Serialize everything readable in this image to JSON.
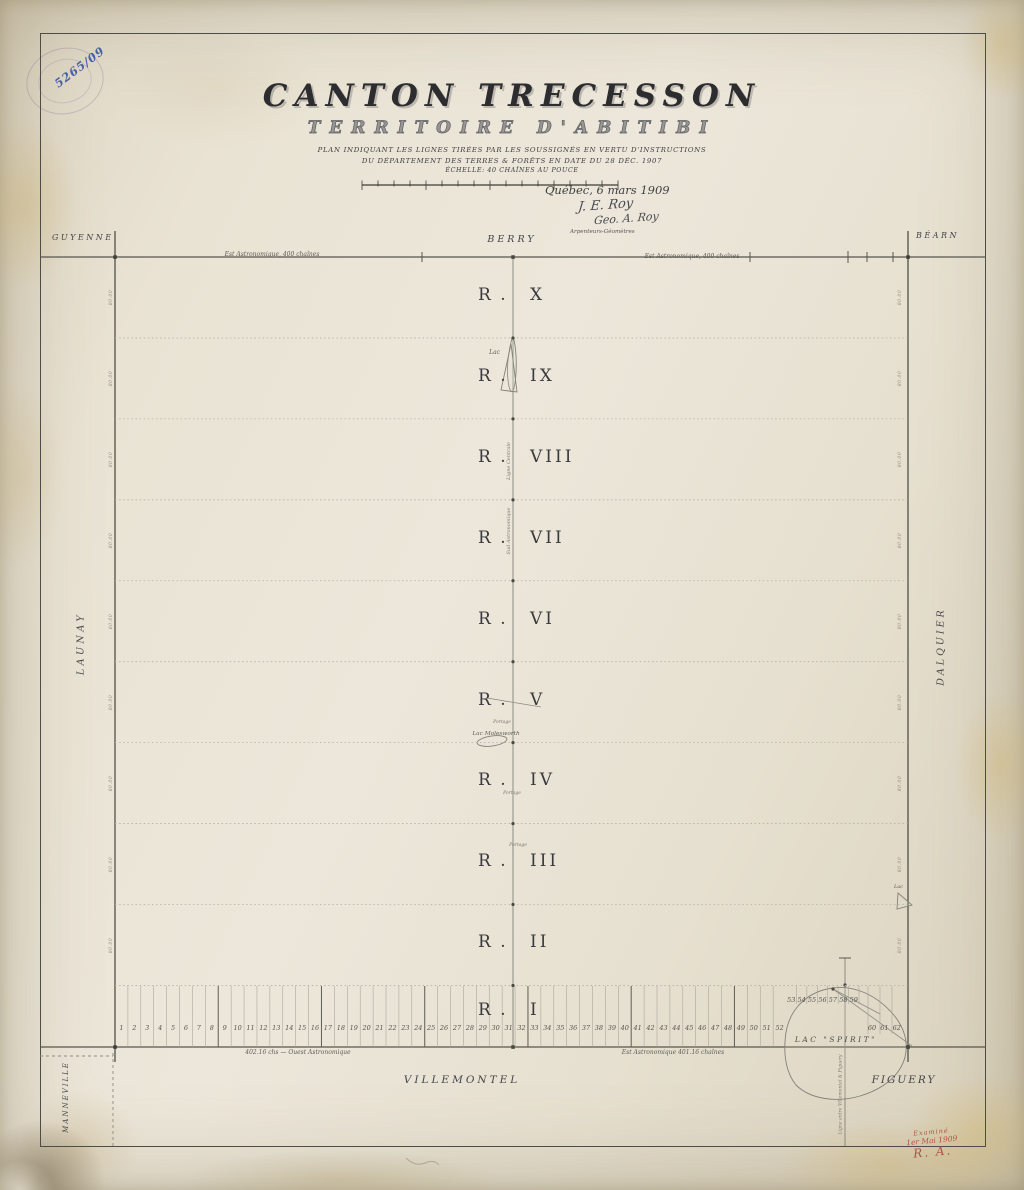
{
  "marginalia": {
    "file_number": "5265/09",
    "examined_line1": "Examiné",
    "examined_line2": "1er Mai 1909",
    "examined_line3": "R. A."
  },
  "title": {
    "main": "CANTON TRECESSON",
    "subtitle": "TERRITOIRE D'ABITIBI",
    "desc_line1": "PLAN INDIQUANT LES LIGNES TIRÉES PAR LES SOUSSIGNÉS EN VERTU D'INSTRUCTIONS",
    "desc_line2": "DU DÉPARTEMENT DES TERRES & FORÊTS EN DATE DU 28 DÉC. 1907",
    "scale_label": "ÉCHELLE: 40 CHAÎNES AU POUCE",
    "place_date": "Québec, 6 mars 1909",
    "signature1": "J. E. Roy",
    "signature2": "Geo. A. Roy",
    "signature_role": "Arpenteurs-Géomètres"
  },
  "neighbors": {
    "top_left": "GUYENNE",
    "top_center": "BERRY",
    "top_right": "BÉARN",
    "left": "LAUNAY",
    "right": "DALQUIER",
    "bottom_left": "MANNEVILLE",
    "bottom_center": "VILLEMONTEL",
    "bottom_right": "FIGUERY"
  },
  "annotations": {
    "top_line_west": "Est Astronomique, 400 chaînes",
    "top_line_east": "Est Astronomique, 400 chaînes",
    "bottom_line_west": "402.16 chs — Ouest Astronomique",
    "bottom_line_east": "Est Astronomique  401.16 chaînes",
    "centre_line_upper": "Ligne Centrale",
    "centre_line_lower": "Sud Astronomique",
    "canton_boundary_line": "Ligne entre Villemontel & Figuery",
    "portage": "Portage",
    "edge_tick_label": "80.00"
  },
  "ranges": {
    "prefix": "R .",
    "numerals": [
      "X",
      "IX",
      "VIII",
      "VII",
      "VI",
      "V",
      "IV",
      "III",
      "II",
      "I"
    ]
  },
  "lakes": {
    "small_centre": "Lac",
    "molesworth": "Lac Molesworth",
    "small_east": "Lac",
    "spirit": "LAC \"SPIRIT\""
  },
  "lots": {
    "numbers": [
      "1",
      "2",
      "3",
      "4",
      "5",
      "6",
      "7",
      "8",
      "9",
      "10",
      "11",
      "12",
      "13",
      "14",
      "15",
      "16",
      "17",
      "18",
      "19",
      "20",
      "21",
      "22",
      "23",
      "24",
      "25",
      "26",
      "27",
      "28",
      "29",
      "30",
      "31",
      "32",
      "33",
      "34",
      "35",
      "36",
      "37",
      "38",
      "39",
      "40",
      "41",
      "42",
      "43",
      "44",
      "45",
      "46",
      "47",
      "48",
      "49",
      "50",
      "51",
      "52",
      "53",
      "54",
      "55",
      "56",
      "57",
      "58",
      "59",
      "60",
      "61",
      "62"
    ]
  }
}
